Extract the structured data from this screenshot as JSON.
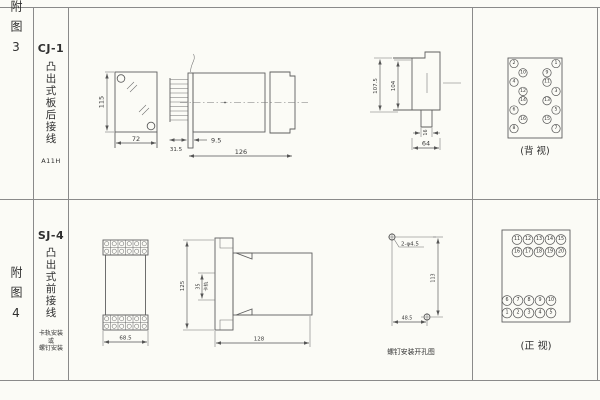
{
  "page": {
    "bg": "#fbfbf6",
    "line_color": "#8a8a8a"
  },
  "rows": [
    {
      "index": "附图3",
      "title": "CJ-1",
      "subtitle": "凸出式板后接线",
      "code": "A11H"
    },
    {
      "index": "附图4",
      "title": "SJ-4",
      "subtitle": "凸出式前接线",
      "mount_note": [
        "卡轨安装",
        "或",
        "螺钉安装"
      ]
    }
  ],
  "fig3": {
    "front_view": {
      "height_dim": "115",
      "width_dim": "72"
    },
    "side_view": {
      "flange_dim": "31.5",
      "offset_dim": "9.5",
      "total_dim": "126"
    },
    "panel_view": {
      "outer_dim": "107.5",
      "inner_dim": "104",
      "tab_dim": "16",
      "width_dim": "64"
    },
    "rear_view": {
      "caption": "(背 视)",
      "left_terminals": [
        "2",
        "10",
        "4",
        "12",
        "14",
        "6",
        "16",
        "8"
      ],
      "right_terminals": [
        "1",
        "9",
        "11",
        "3",
        "13",
        "5",
        "15",
        "7"
      ]
    }
  },
  "fig4": {
    "front_view": {
      "width_dim": "68.5"
    },
    "side_view": {
      "height_dim": "125",
      "rail_dim": "35",
      "rail_label": "卡轨",
      "length_dim": "128"
    },
    "drill_view": {
      "hole_label": "2-φ4.5",
      "height_dim": "113",
      "width_dim": "48.5",
      "caption": "螺钉安装开孔图"
    },
    "front_terminal_view": {
      "caption": "(正 视)",
      "rows": [
        [
          "11",
          "12",
          "13",
          "14",
          "15"
        ],
        [
          "16",
          "17",
          "18",
          "19",
          "20"
        ],
        [
          "6",
          "7",
          "8",
          "9",
          "10"
        ],
        [
          "1",
          "2",
          "3",
          "4",
          "5"
        ]
      ]
    }
  }
}
